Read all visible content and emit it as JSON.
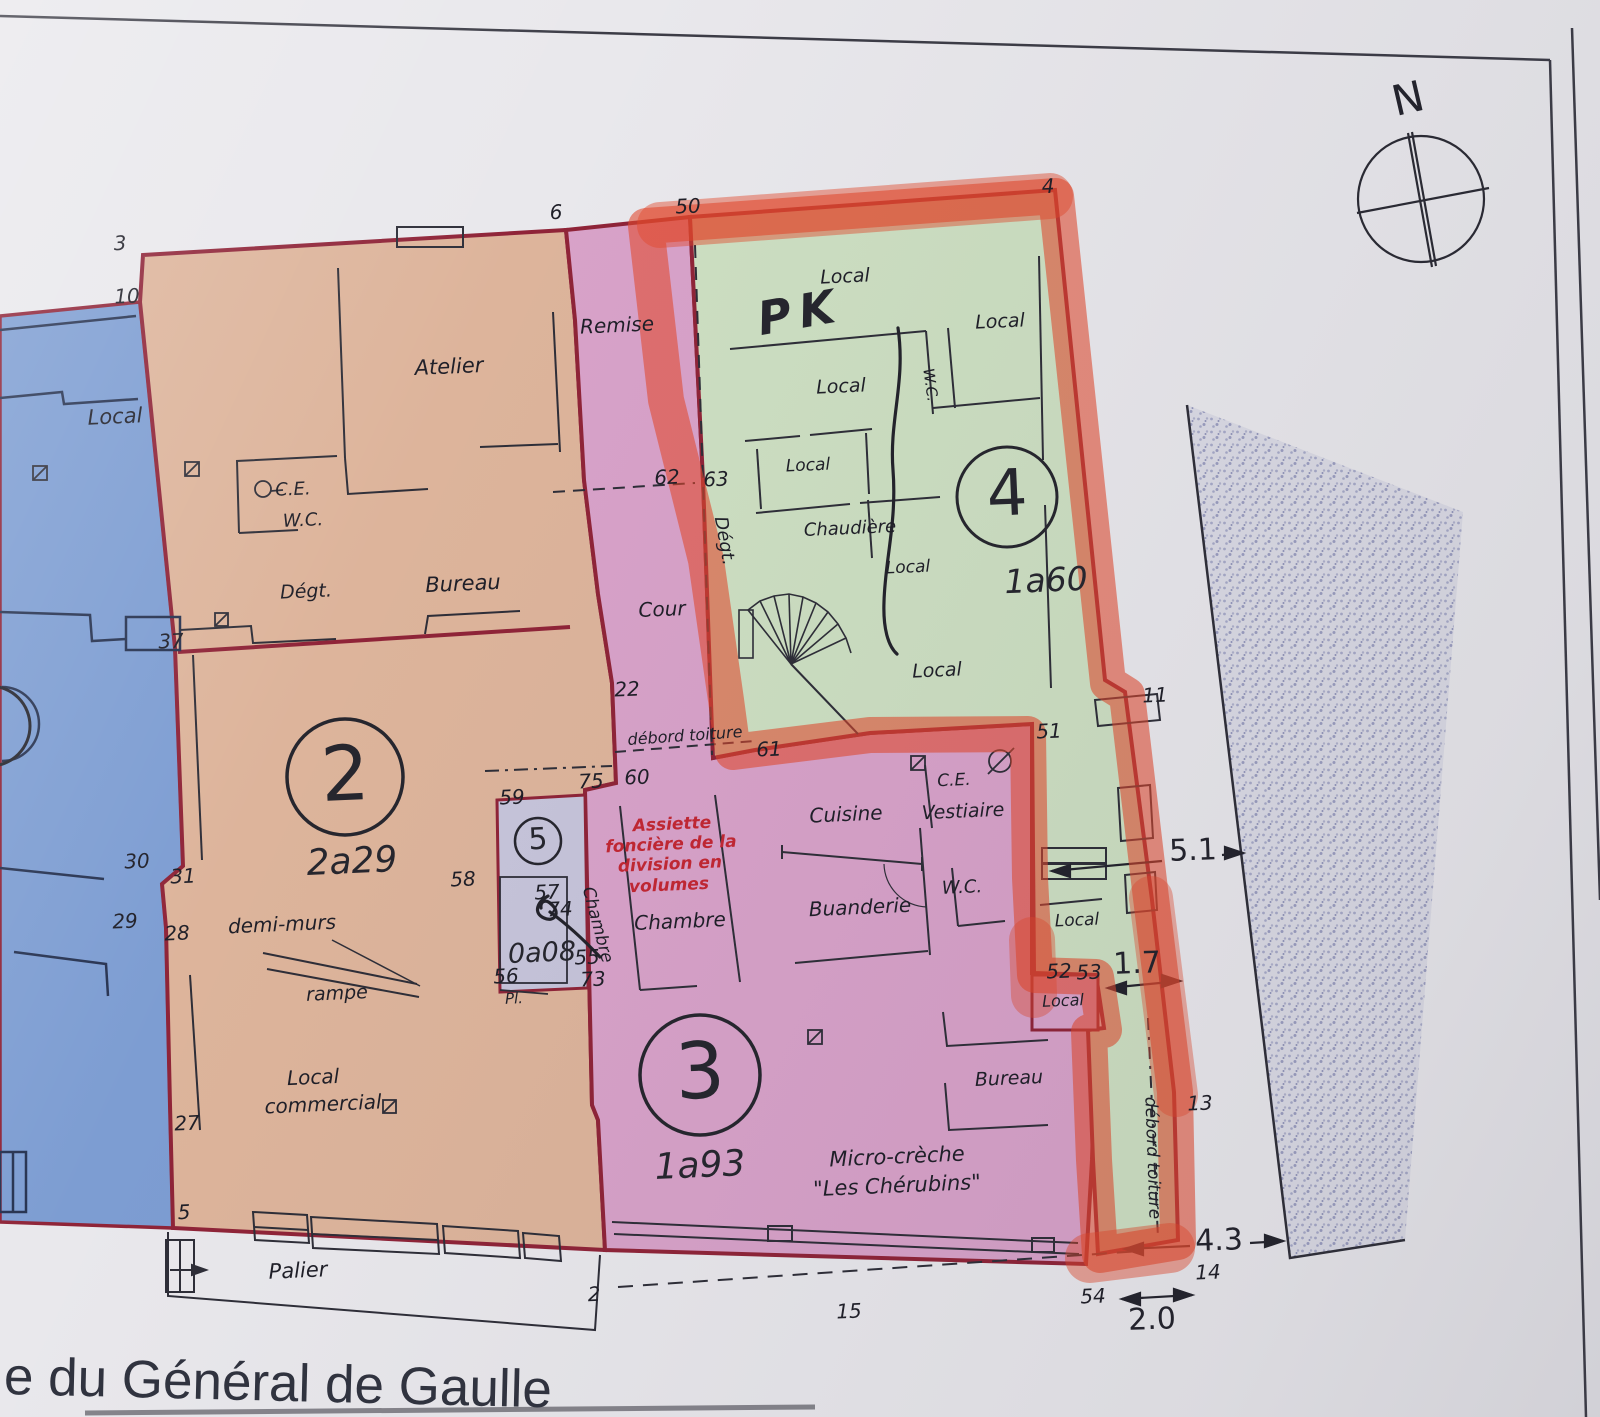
{
  "meta": {
    "caption": "e du Général de Gaulle",
    "compass_n": "N"
  },
  "volumes": [
    {
      "num": "2",
      "area": "2a29"
    },
    {
      "num": "3",
      "area": "1a93"
    },
    {
      "num": "4",
      "area": "1a60"
    },
    {
      "num": "5",
      "area": "0a08"
    }
  ],
  "rooms": {
    "local": "Local",
    "atelier": "Atelier",
    "ce": "C.E.",
    "wc": "W.C.",
    "degt": "Dégt.",
    "bureau": "Bureau",
    "demi_murs": "demi-murs",
    "rampe": "rampe",
    "local_commercial_1": "Local",
    "local_commercial_2": "commercial",
    "palier": "Palier",
    "remise": "Remise",
    "cour": "Cour",
    "chambre": "Chambre",
    "cuisine": "Cuisine",
    "buanderie": "Buanderie",
    "vestiaire": "Vestiaire",
    "chaudiere": "Chaudière",
    "micro_creche_1": "Micro-crèche",
    "micro_creche_2": "\"Les Chérubins\"",
    "pl": "Pl."
  },
  "annotations": {
    "assiette_1": "Assiette",
    "assiette_2": "foncière de la",
    "assiette_3": "division en",
    "assiette_4": "volumes",
    "debord_toiture": "débord toiture",
    "handwritten_pk": "PK"
  },
  "points": [
    "3",
    "10",
    "6",
    "50",
    "4",
    "62",
    "63",
    "37",
    "22",
    "59",
    "75",
    "60",
    "61",
    "51",
    "11",
    "58",
    "57",
    "74",
    "55",
    "56",
    "73",
    "30",
    "31",
    "29",
    "28",
    "27",
    "5",
    "2",
    "15",
    "54",
    "52",
    "53",
    "13",
    "14"
  ],
  "measurements": [
    "5.1",
    "1.7",
    "4.3",
    "2.0"
  ],
  "colors": {
    "paper": "#e9e8ec",
    "adjacent_blue": "#7d9dd2",
    "volume2_orange": "#ddb49b",
    "volume3_pink": "#d8a2c9",
    "volume4_green": "#cddfc2",
    "volume5_lavender": "#c6c4da",
    "boundary_dark_red": "#8f2438",
    "highlighter_red": "#e2492c",
    "annotation_red": "#c22733",
    "road_stipple": "#a7aac8"
  }
}
